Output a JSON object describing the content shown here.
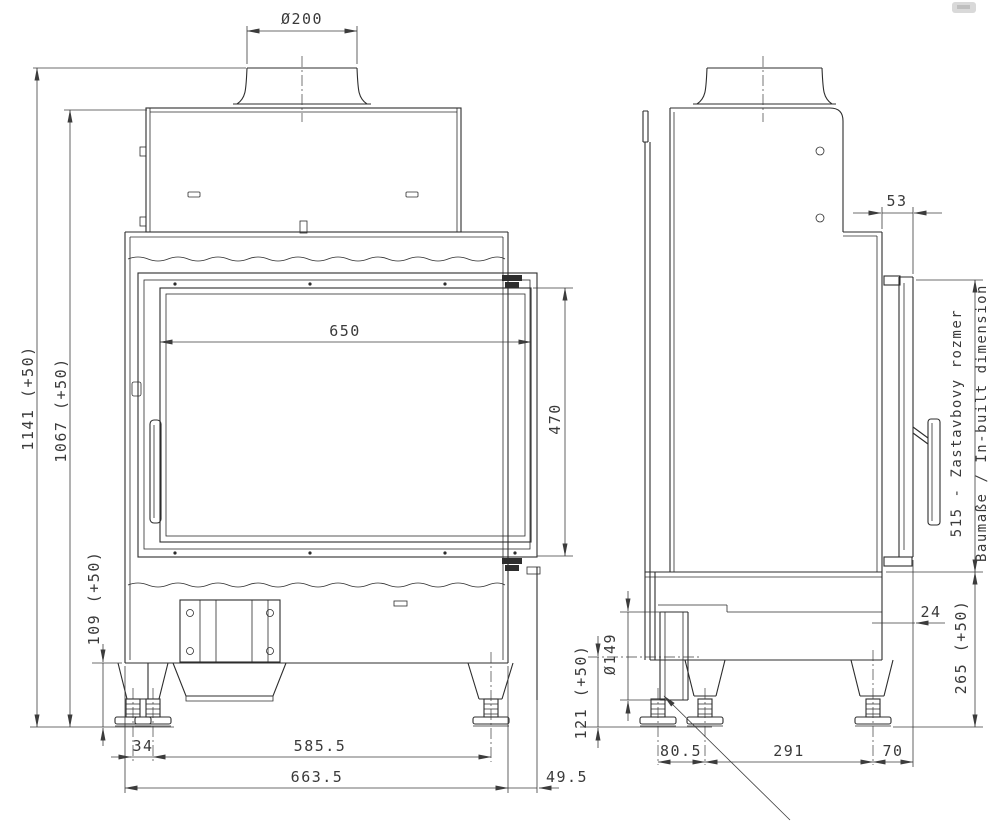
{
  "front_view": {
    "dimensions": {
      "flue_diameter": "Ø200",
      "overall_height": "1141 (+50)",
      "body_height": "1067 (+50)",
      "glass_width": "650",
      "glass_height": "470",
      "base_height": "109 (+50)",
      "rear_foot_offset": "34",
      "feet_span": "585.5",
      "overall_width": "663.5",
      "frame_overhang": "49.5"
    }
  },
  "side_view": {
    "dimensions": {
      "frame_depth": "53",
      "frame_thickness": "24",
      "inbuilt_note_sk": "515 - Zastavbovy rozmer",
      "inbuilt_note_de_en": "Baumaße / In-built dimension",
      "plinth_height": "265 (+50)",
      "air_intake_diameter": "Ø149",
      "air_intake_height": "121 (+50)",
      "rear_feet_spacing": "80.5",
      "feet_span": "291",
      "front_foot_offset": "70"
    }
  }
}
